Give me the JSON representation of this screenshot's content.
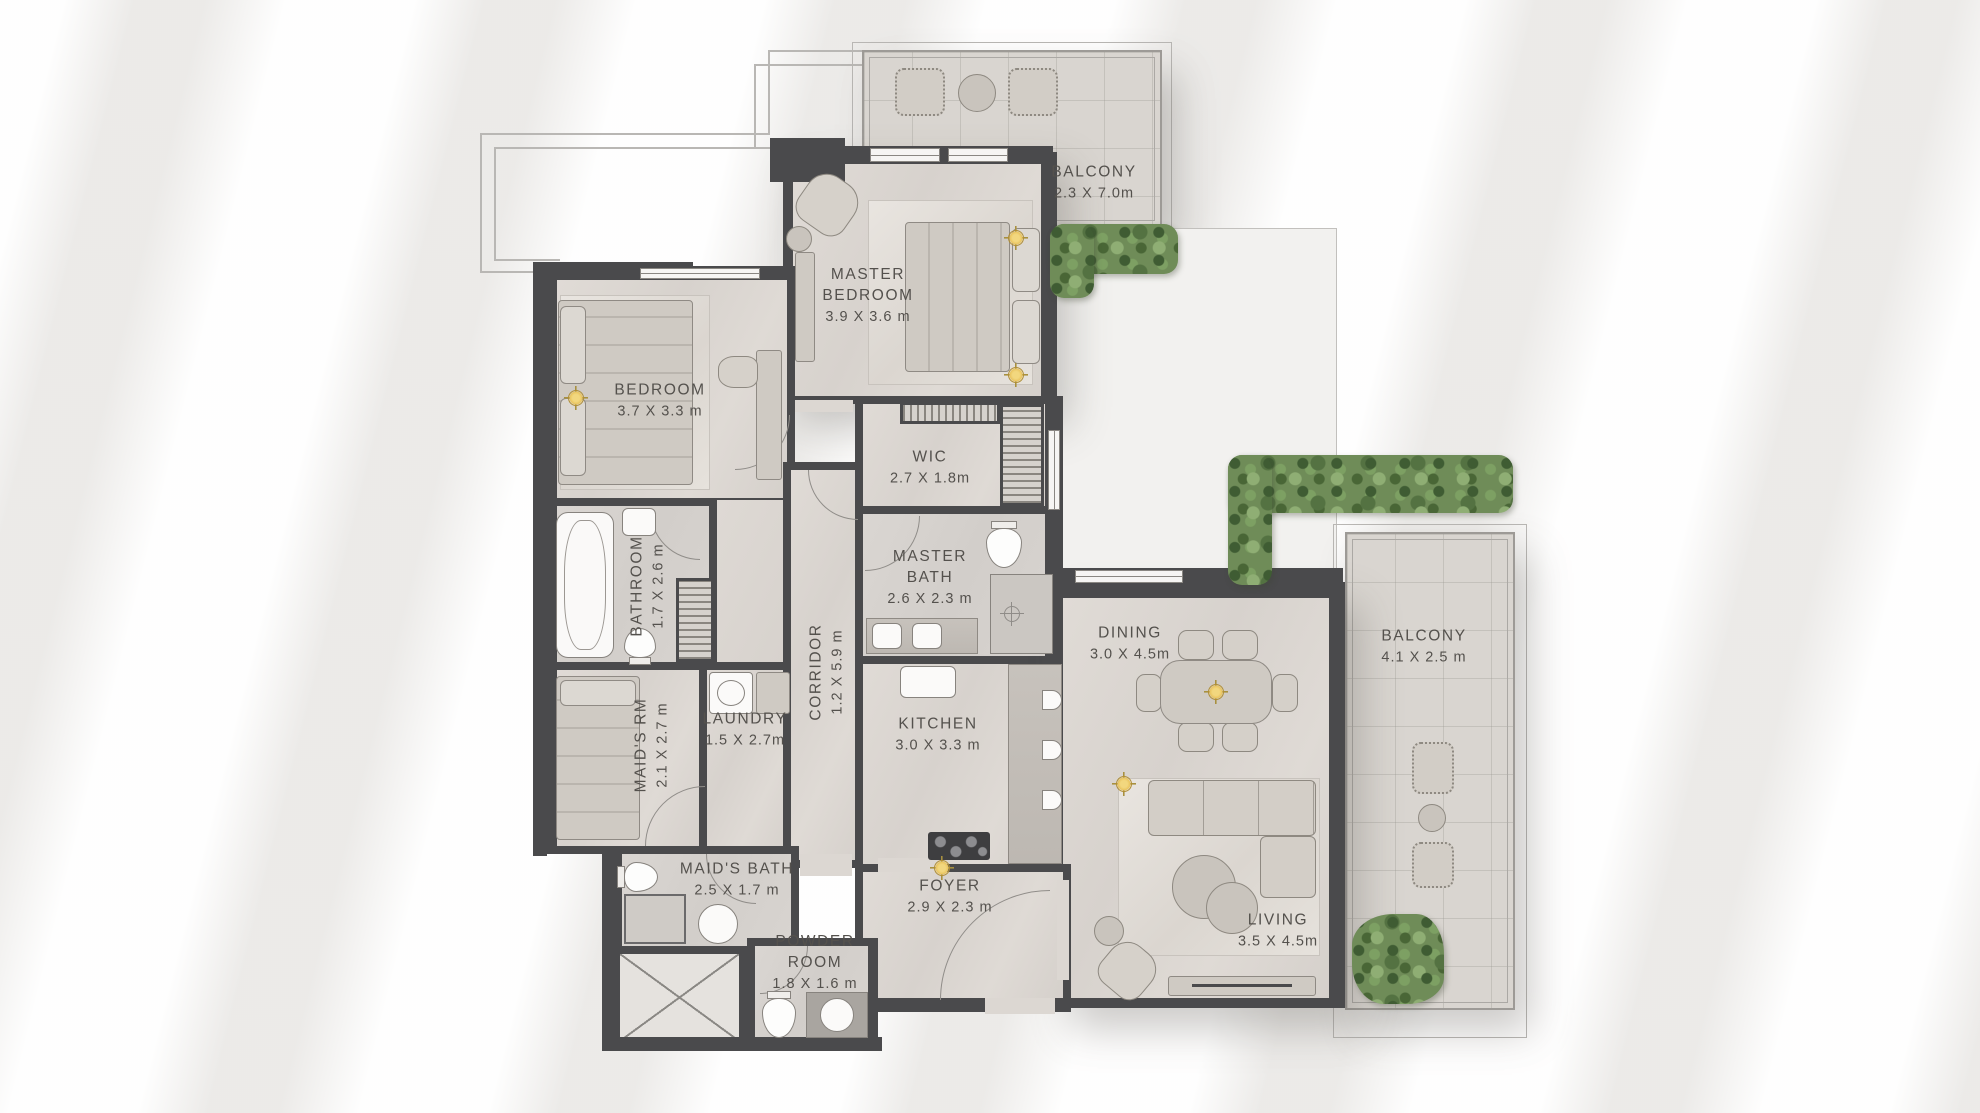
{
  "plan": {
    "type": "apartment-floor-plan",
    "colors": {
      "wall": "#4A4A4C",
      "floor": "#DCD7D2",
      "background": "#F6F5F4",
      "hedge_green": "#6F8C58",
      "accent_gold": "#E9C45F"
    },
    "rooms": {
      "balcony_top": {
        "name": "BALCONY",
        "dims": "2.3 X 7.0m"
      },
      "master_bedroom": {
        "name": "MASTER BEDROOM",
        "dims": "3.9 X 3.6 m"
      },
      "bedroom": {
        "name": "BEDROOM",
        "dims": "3.7 X 3.3 m"
      },
      "wic": {
        "name": "WIC",
        "dims": "2.7 X 1.8m"
      },
      "master_bath": {
        "name": "MASTER BATH",
        "dims": "2.6 X 2.3 m"
      },
      "bathroom": {
        "name": "BATHROOM",
        "dims": "1.7 X 2.6 m"
      },
      "corridor": {
        "name": "CORRIDOR",
        "dims": "1.2 X 5.9 m"
      },
      "maids_rm": {
        "name": "MAID'S RM",
        "dims": "2.1 X 2.7 m"
      },
      "laundry": {
        "name": "LAUNDRY",
        "dims": "1.5 X 2.7m"
      },
      "kitchen": {
        "name": "KITCHEN",
        "dims": "3.0 X 3.3 m"
      },
      "dining": {
        "name": "DINING",
        "dims": "3.0 X 4.5m"
      },
      "balcony_right": {
        "name": "BALCONY",
        "dims": "4.1 X 2.5 m"
      },
      "maids_bath": {
        "name": "MAID'S BATH",
        "dims": "2.5 X 1.7 m"
      },
      "foyer": {
        "name": "FOYER",
        "dims": "2.9 X 2.3 m"
      },
      "powder_room": {
        "name": "POWDER ROOM",
        "dims": "1.8 X 1.6 m"
      },
      "living": {
        "name": "LIVING",
        "dims": "3.5 X 4.5m"
      }
    }
  }
}
